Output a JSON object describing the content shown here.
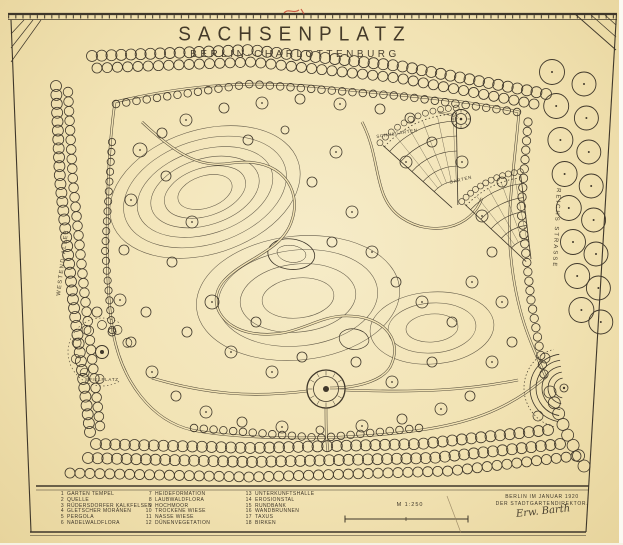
{
  "title": {
    "main": "SACHSENPLATZ",
    "sub": "BERLIN·CHARLOTTENBURG"
  },
  "plan_labels": {
    "schulgarten": "SCHULGARTEN",
    "garten": "GARTEN",
    "spielplatz": "SPIELPLATZ",
    "street_left": "WESTEND-ALLEE",
    "street_right": "REICHS STRASSE"
  },
  "legend": {
    "cols": [
      {
        "items": [
          {
            "n": "1",
            "t": "GARTEN TEMPEL"
          },
          {
            "n": "2",
            "t": "QUELLE"
          },
          {
            "n": "3",
            "t": "RÜDERSDORFER KALKFELSEN"
          },
          {
            "n": "4",
            "t": "GLETSCHER MORÄNEN"
          },
          {
            "n": "5",
            "t": "PERGOLA"
          },
          {
            "n": "6",
            "t": "NADELWALDFLORA"
          }
        ]
      },
      {
        "items": [
          {
            "n": "7",
            "t": "HEIDEFORMATION"
          },
          {
            "n": "8",
            "t": "LAUBWALDFLORA"
          },
          {
            "n": "9",
            "t": "HOCHMOOR"
          },
          {
            "n": "10",
            "t": "TROCKENE WIESE"
          },
          {
            "n": "11",
            "t": "NASSE WIESE"
          },
          {
            "n": "12",
            "t": "DÜNENVEGETATION"
          }
        ]
      },
      {
        "items": [
          {
            "n": "13",
            "t": "UNTERKUNFTSHALLE"
          },
          {
            "n": "14",
            "t": "EROSIONSTAL"
          },
          {
            "n": "15",
            "t": "RUNDBANK"
          },
          {
            "n": "16",
            "t": "WANDBRUNNEN"
          },
          {
            "n": "17",
            "t": "TAXUS"
          },
          {
            "n": "18",
            "t": "BIRKEN"
          }
        ]
      }
    ]
  },
  "scale": {
    "label": "M 1:250"
  },
  "colophon": {
    "line1": "BERLIN IM JANUAR 1920",
    "line2": "DER STADTGARTENDIREKTOR.",
    "signature": "Erw. Barth"
  },
  "colors": {
    "paper": "#f2e3b4",
    "ink": "#3f372a",
    "red": "#c03a28",
    "pencil": "#95825f"
  }
}
